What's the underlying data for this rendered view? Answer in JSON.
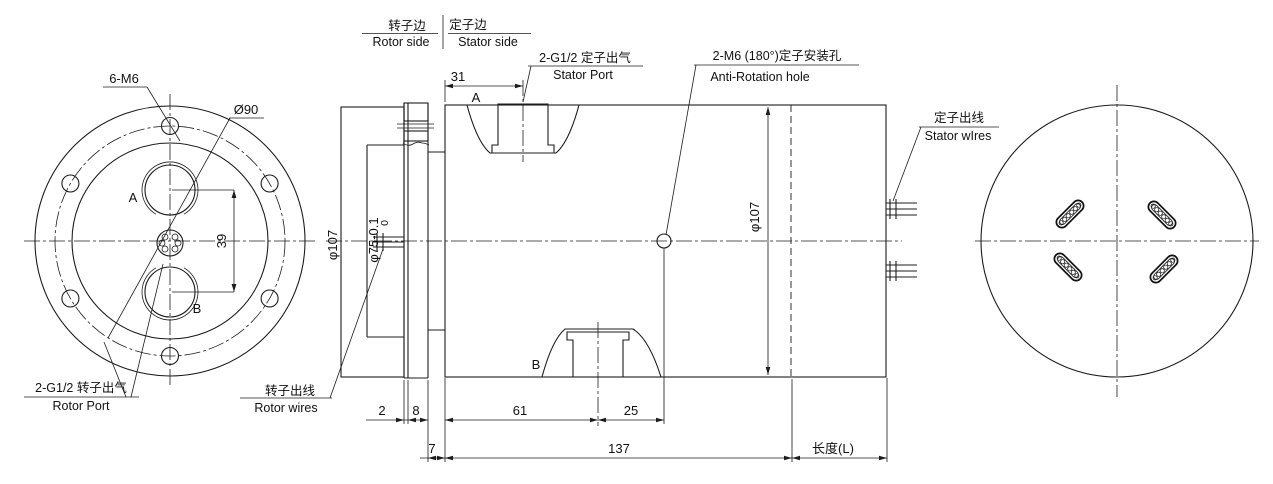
{
  "front_view": {
    "bolt_callout": "6-M6",
    "bolt_circle_dia": "Ø90",
    "port_a_label": "A",
    "port_b_label": "B",
    "port_spacing": "39",
    "rotor_port_cn": "2-G1/2 转子出气",
    "rotor_port_en": "Rotor Port"
  },
  "section_view": {
    "rotor_side_cn": "转子边",
    "rotor_side_en": "Rotor side",
    "stator_side_cn": "定子边",
    "stator_side_en": "Stator side",
    "stator_port_cn": "2-G1/2 定子出气",
    "stator_port_en": "Stator Port",
    "anti_rotation_cn": "2-M6 (180°)定子安装孔",
    "anti_rotation_en": "Anti-Rotation hole",
    "stator_wires_cn": "定子出线",
    "stator_wires_en": "Stator wIres",
    "rotor_wires_cn": "转子出线",
    "rotor_wires_en": "Rotor wires",
    "port_a_label": "A",
    "port_b_label": "B",
    "dim_stator_port_offset": "31",
    "dim_flange_dia": "φ107",
    "dim_boss_tol_upper": "0",
    "dim_boss_dia": "φ75-0.1",
    "dim_plate": "2",
    "dim_spacer": "8",
    "dim_neck": "7",
    "dim_port_b_offset": "61",
    "dim_anti_hole_offset": "25",
    "dim_body_len": "137",
    "dim_total_len": "长度(L)",
    "dim_body_dia": "φ107"
  }
}
